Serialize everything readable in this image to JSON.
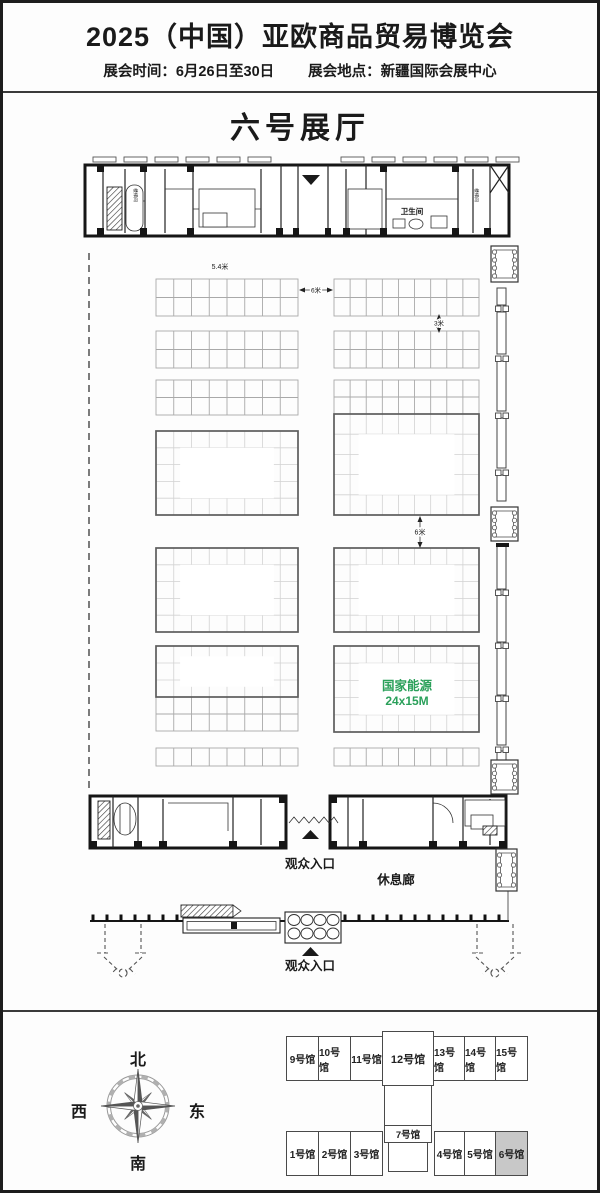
{
  "header": {
    "title": "2025（中国）亚欧商品贸易博览会",
    "schedule": "展会时间：6月26日至30日",
    "venue": "展会地点：新疆国际会展中心"
  },
  "hall_title": "六号展厅",
  "plan": {
    "ceiling_height_label": "5.4米",
    "aisle_width_horizontal": "6米",
    "aisle_width_small": "3米",
    "aisle_width_vertical": "6米",
    "restroom_label": "卫生间",
    "stairwell_left_label": "楼梯间",
    "stairwell_right_label": "楼梯间",
    "featured_booth": {
      "name": "国家能源",
      "size": "24x15M",
      "color": "#2aa05a"
    },
    "visitor_entrance_top": "观众入口",
    "rest_corridor": "休息廊",
    "visitor_entrance_bottom": "观众入口"
  },
  "legend": {
    "compass": {
      "north": "北",
      "south": "南",
      "east": "东",
      "west": "西"
    },
    "halls_top": [
      "9号馆",
      "10号馆",
      "11号馆",
      "12号馆",
      "13号馆",
      "14号馆",
      "15号馆"
    ],
    "hall_7": "7号馆",
    "halls_bottom": [
      "1号馆",
      "2号馆",
      "3号馆",
      "4号馆",
      "5号馆",
      "6号馆"
    ],
    "highlighted_hall": "6号馆",
    "highlight_color": "#c8c8c8"
  }
}
